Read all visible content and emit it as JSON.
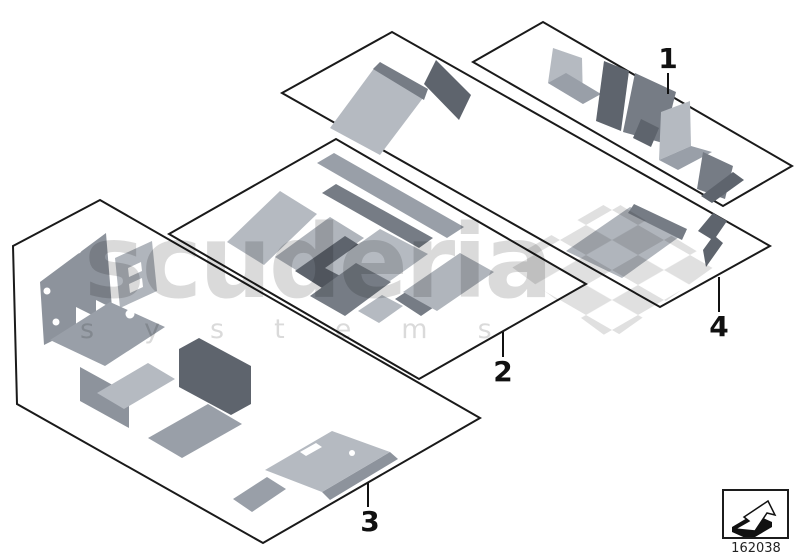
{
  "diagram": {
    "title_hidden": "",
    "callouts": [
      {
        "label": "1"
      },
      {
        "label": "2"
      },
      {
        "label": "3"
      },
      {
        "label": "4"
      }
    ],
    "part_number": "162038",
    "nav_icon": "direction-arrow-icon"
  },
  "watermark": {
    "brand": "scuderia",
    "sub": "systems",
    "flag_icon": "checkered-flag-icon"
  },
  "colors": {
    "outline": "#1a1a1a",
    "part_light": "#b5bac1",
    "part_mid": "#999fa8",
    "part_dark": "#767c85",
    "part_vdark": "#5e646d",
    "watermark_gray": "#d9d9d9"
  }
}
